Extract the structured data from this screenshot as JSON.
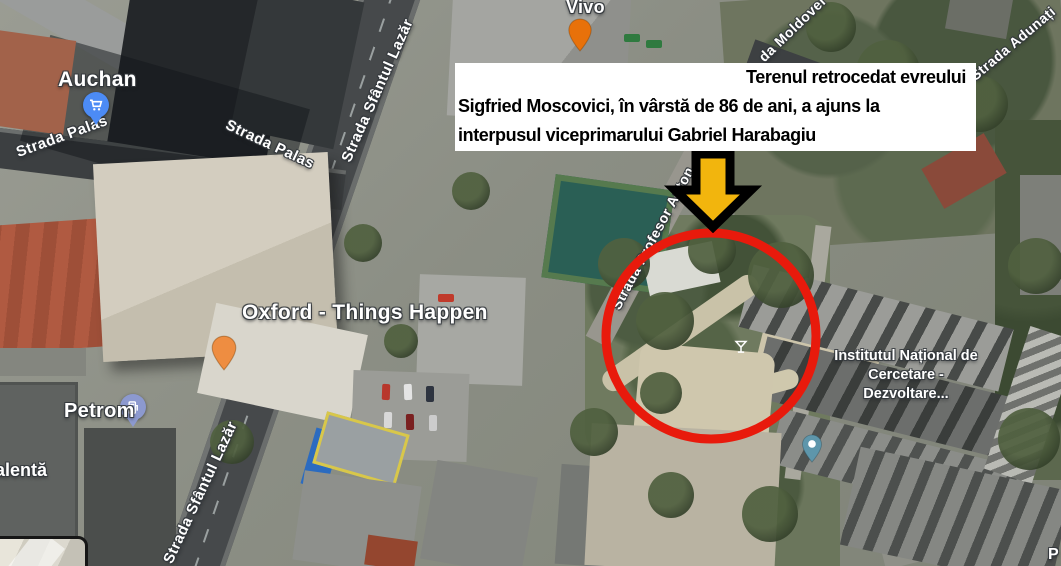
{
  "annotation_box": {
    "line1": "Terenul retrocedat evreului",
    "line2": "Sigfried Moscovici, în vârstă de 86 de ani, a ajuns la",
    "line3": "interpusul viceprimarului Gabriel Harabagiu"
  },
  "highlight": {
    "circle_color": "#e81a0c",
    "arrow_fill": "#f2b50d",
    "arrow_outline": "#000000"
  },
  "pois": [
    {
      "name": "Auchan",
      "icon": "shopping-cart-icon",
      "pin_color": "#4c8bf5"
    },
    {
      "name": "Vivo",
      "icon": "restaurant-icon",
      "pin_color": "#e8710a"
    },
    {
      "name": "Oxford - Things Happen",
      "icon": "cocktail-icon",
      "pin_color": "#ee8d41"
    },
    {
      "name": "Petrom",
      "icon": "gas-station-icon",
      "pin_color": "#8c99cf"
    },
    {
      "name": "Institutul Național de Cercetare - Dezvoltare...",
      "icon": "place-icon",
      "pin_color": "#5e96ab"
    }
  ],
  "streets": [
    {
      "name": "Strada Palas"
    },
    {
      "name": "Strada Palas"
    },
    {
      "name": "Strada Sfântul Lazăr"
    },
    {
      "name": "Strada Sfântul Lazăr"
    },
    {
      "name": "Strada Profesor Anton"
    },
    {
      "name": "da Moldovei"
    },
    {
      "name": "Strada Adunați"
    }
  ],
  "partial_labels": [
    {
      "text": "alentă"
    },
    {
      "text": "P"
    }
  ]
}
